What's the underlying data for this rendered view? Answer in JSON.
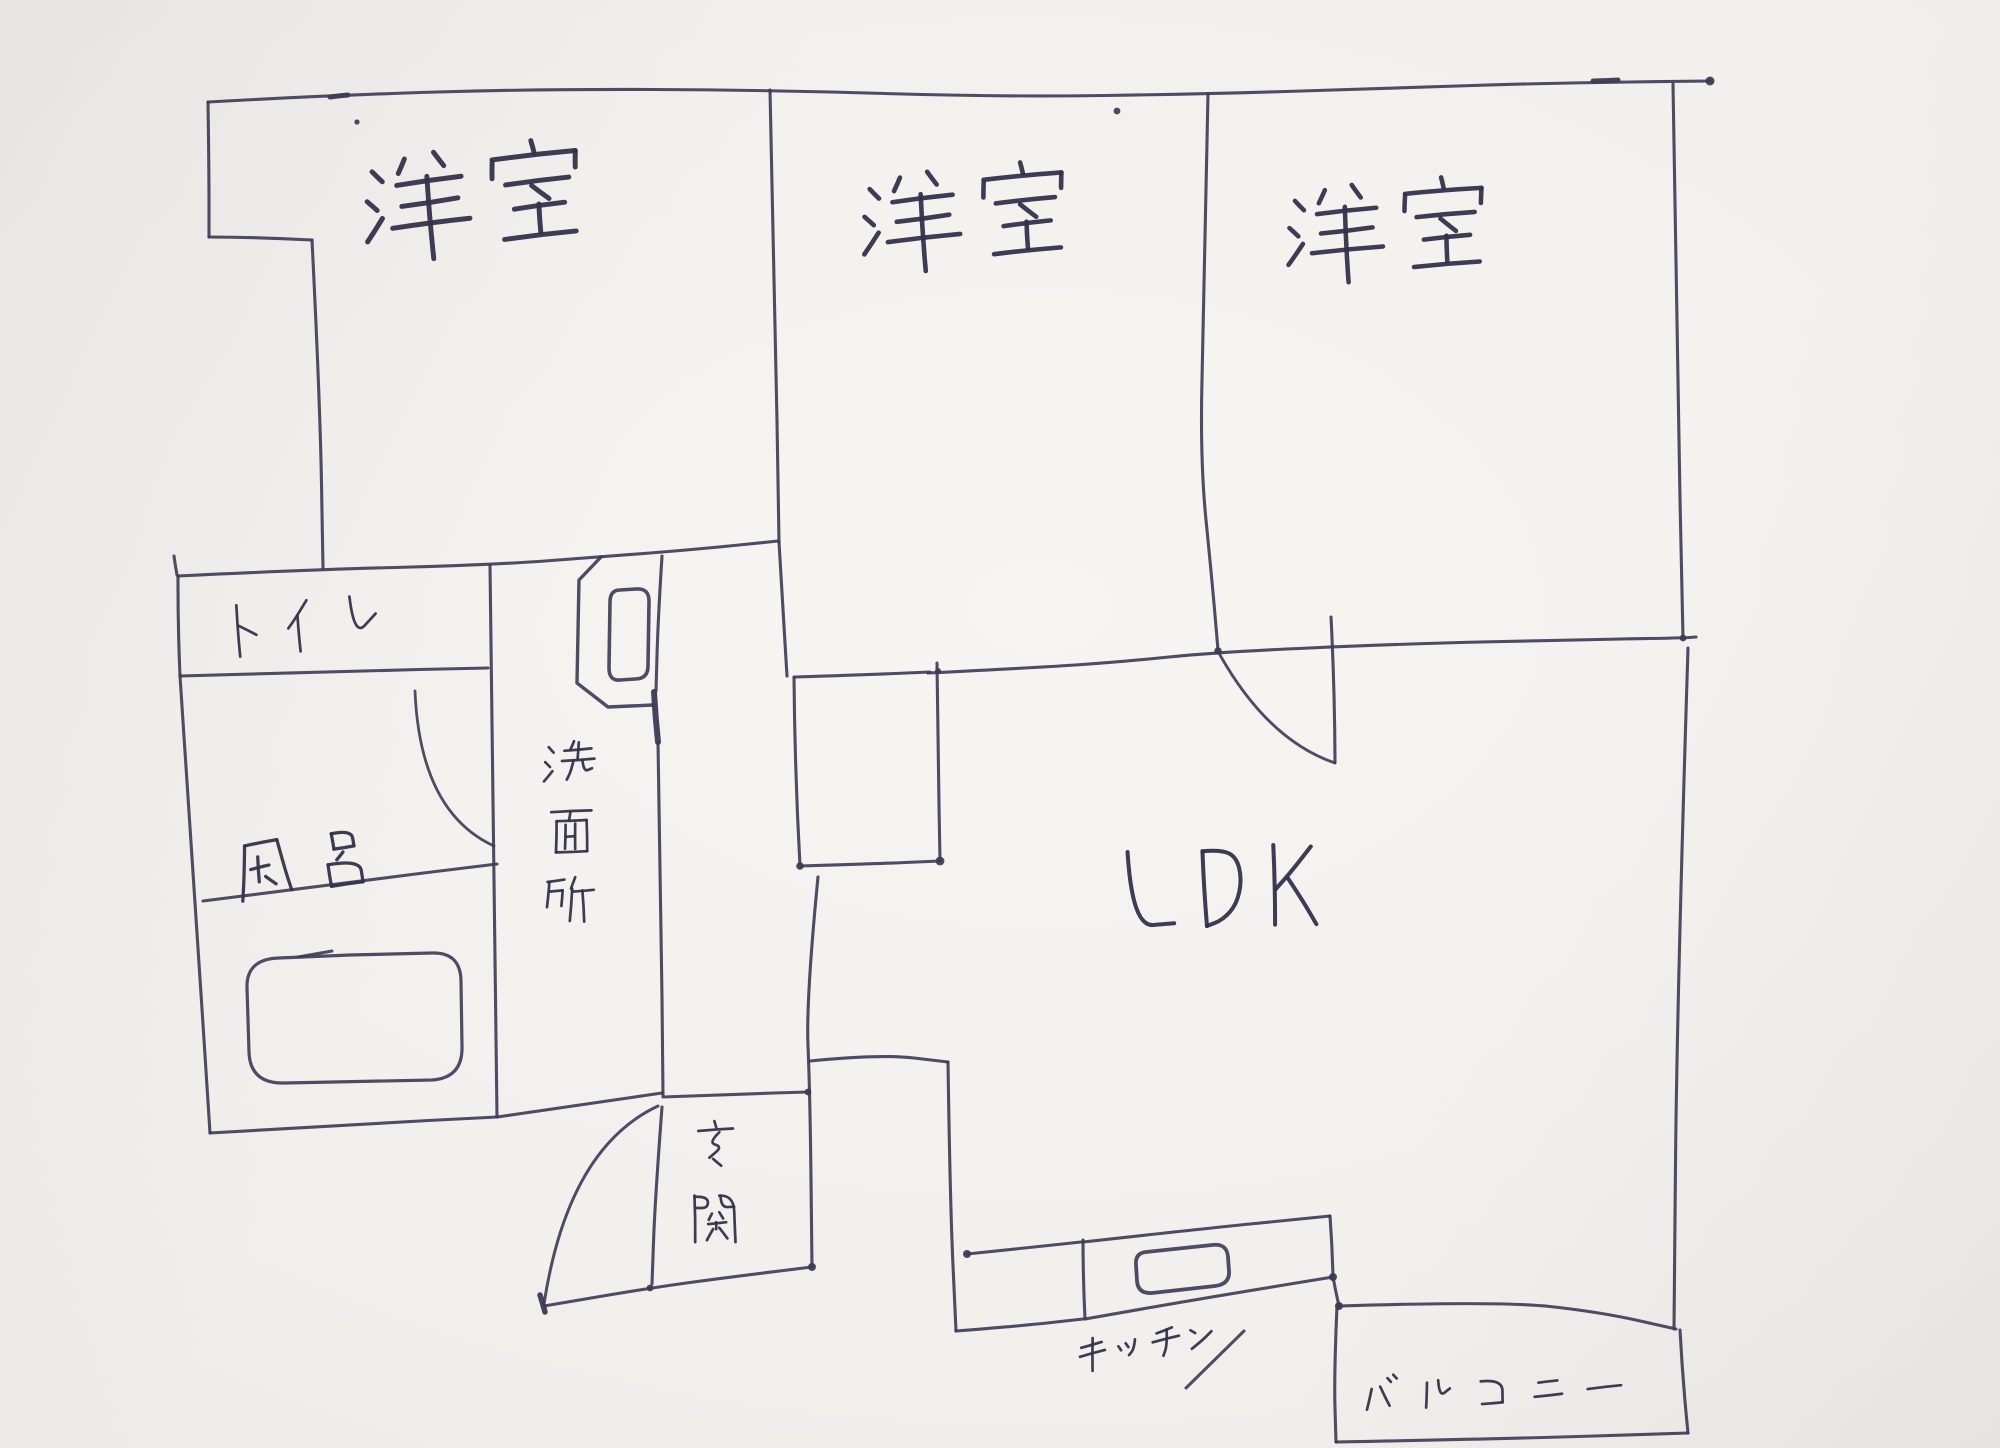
{
  "document": {
    "type": "hand-drawn apartment floor plan sketch",
    "medium": "ink pen on white paper"
  },
  "canvas": {
    "width": 2000,
    "height": 1448
  },
  "palette": {
    "paper": "#f2f0ed",
    "ink": "#3c3a54",
    "label_ink": "#34324b"
  },
  "rooms": [
    {
      "id": "bedroom-1",
      "label": "洋室"
    },
    {
      "id": "bedroom-2",
      "label": "洋室"
    },
    {
      "id": "bedroom-3",
      "label": "洋室"
    },
    {
      "id": "toilet",
      "label": "トイレ"
    },
    {
      "id": "bath",
      "label": "風呂"
    },
    {
      "id": "washroom",
      "label": "洗面所"
    },
    {
      "id": "ldk",
      "label": "LDK"
    },
    {
      "id": "entrance",
      "label": "玄関"
    },
    {
      "id": "kitchen",
      "label": "キッチン"
    },
    {
      "id": "balcony",
      "label": "バルコニー"
    }
  ],
  "fixtures": [
    {
      "id": "bathtub"
    },
    {
      "id": "wash-basin"
    },
    {
      "id": "kitchen-sink"
    },
    {
      "id": "entrance-door-swing"
    },
    {
      "id": "bath-door-swing"
    },
    {
      "id": "ldk-door-swing"
    }
  ]
}
